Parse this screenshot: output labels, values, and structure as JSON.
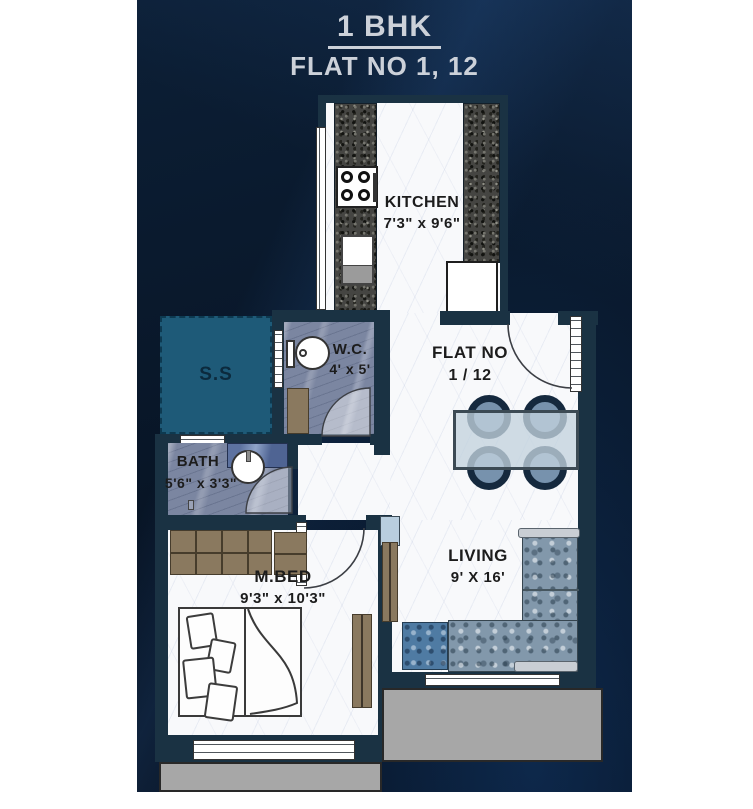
{
  "title": {
    "heading": "1 BHK",
    "subheading": "FLAT NO 1, 12"
  },
  "rooms": {
    "kitchen": {
      "name": "KITCHEN",
      "size": "7'3\" x 9'6\""
    },
    "flat": {
      "name": "FLAT NO",
      "size": "1 / 12"
    },
    "wc": {
      "name": "W.C.",
      "size": "4' x 5'"
    },
    "ss": {
      "name": "S.S"
    },
    "bath": {
      "name": "BATH",
      "size": "5'6\" x 3'3\""
    },
    "mbed": {
      "name": "M.BED",
      "size": "9'3\" x 10'3\""
    },
    "living": {
      "name": "LIVING",
      "size": "9' X 16'"
    }
  },
  "colors": {
    "card_navy": "#081526",
    "wall": "#1a3243",
    "ss_teal": "#1e5a78",
    "floor_marble": "#f8f9fb",
    "tile_blue": "#7b86a1",
    "granite_dark": "#454542",
    "wood_brown": "#8a795f",
    "balcony_gray": "#a7a7a7",
    "table_blue": "#c3d2de",
    "chair_navy": "#15293e",
    "chair_seat": "#7792ad",
    "title_text": "#ccd1d9"
  }
}
